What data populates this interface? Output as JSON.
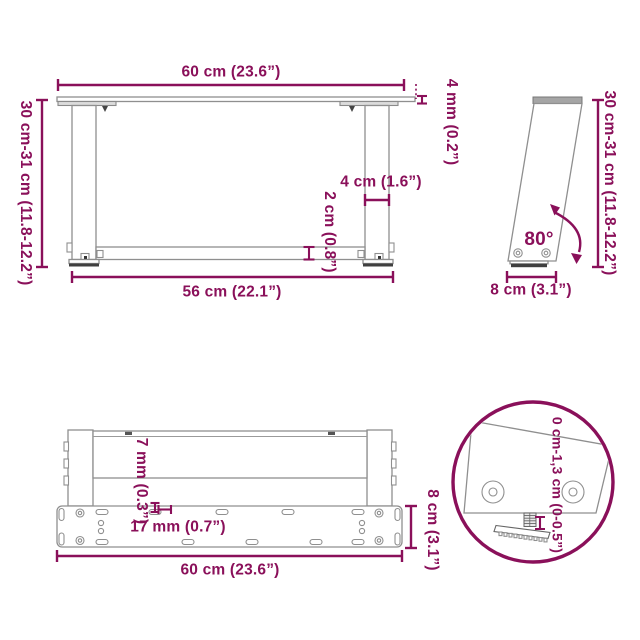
{
  "colors": {
    "accent": "#8A105A",
    "line_gray": "#8f8f8f",
    "dark_gray": "#3f3f3f"
  },
  "views": {
    "front": {
      "width_top": "60 cm (23.6”)",
      "height_left": "30 cm-31 cm (11.8-12.2”)",
      "top_thickness": "4 mm (0.2”)",
      "leg_width": "4 cm (1.6”)",
      "crossbar_thickness": "2 cm (0.8”)",
      "width_bottom": "56 cm (22.1”)"
    },
    "side": {
      "height_right": "30 cm-31 cm (11.8-12.2”)",
      "angle": "80°",
      "foot_depth": "8 cm (3.1”)"
    },
    "bottom": {
      "sheet_thickness": "7 mm (0.3”)",
      "slot_length": "17 mm (0.7”)",
      "plate_depth": "8 cm (3.1”)",
      "width": "60 cm (23.6”)"
    },
    "detail": {
      "adjust_range": "0 cm-1,3 cm (0-0.5”)"
    }
  }
}
